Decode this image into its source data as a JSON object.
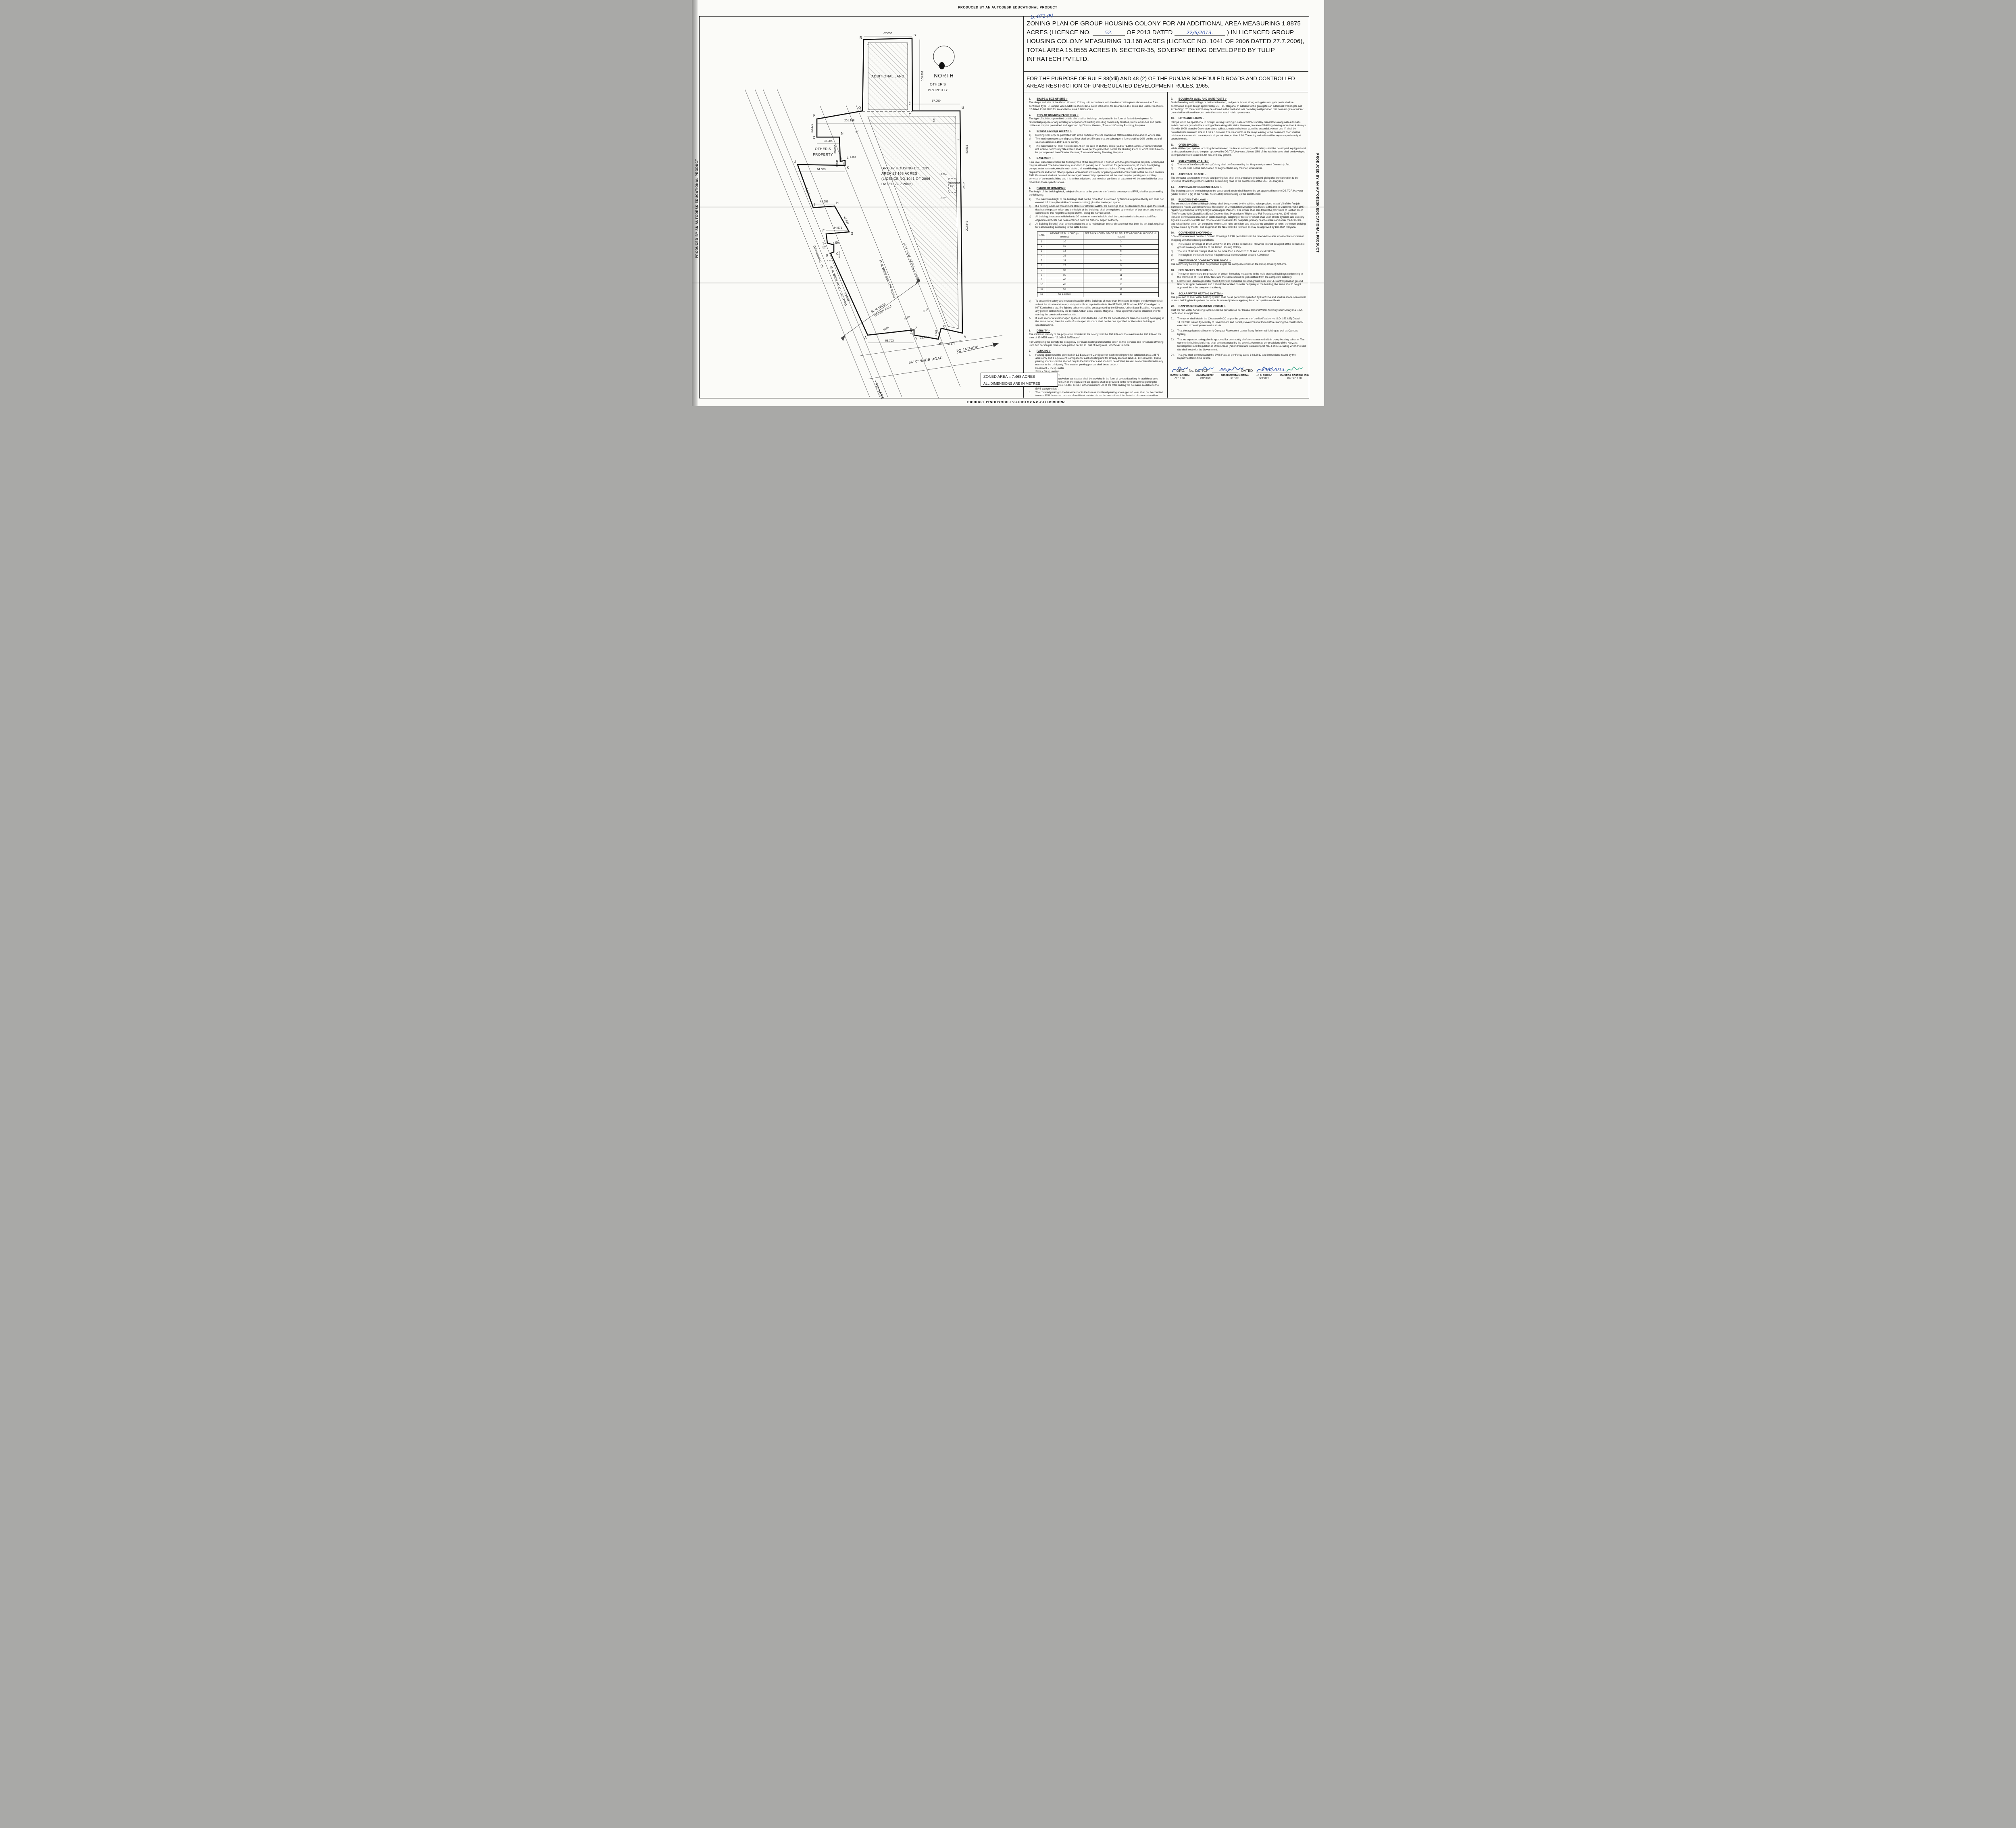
{
  "edge_text": "PRODUCED BY AN AUTODESK EDUCATIONAL PRODUCT",
  "header": {
    "ref_handwritten": "Lc-871 (R)",
    "title_part1": "ZONING PLAN OF GROUP HOUSING COLONY FOR AN ADDITIONAL AREA MEASURING 1.8875 ACRES (LICENCE NO.",
    "licence_no_handwritten": "52.",
    "title_part2": "OF 2013 DATED",
    "licence_date_handwritten": "22/6/2013.",
    "title_part3": ") IN LICENCED GROUP HOUSING COLONY MEASURING 13.168 ACRES (LICENCE NO. 1041 OF 2006 DATED 27.7.2006), TOTAL AREA 15.0555 ACRES IN SECTOR-35, SONEPAT BEING DEVELOPED BY TULIP INFRATECH PVT.LTD.",
    "subtitle": "FOR THE PURPOSE OF RULE 38(xlii) AND 48 (2) OF THE PUNJAB SCHEDULED ROADS AND CONTROLLED  AREAS RESTRICTION OF UNREGULATED DEVELOPMENT RULES, 1965."
  },
  "clauses_left": [
    {
      "num": "1.",
      "title": "SHAPE & SIZE OF SITE :-",
      "paras": [
        "The shape and size of the Group Housing Colony is in accordance with the demarcation plans shown as A to Z as confirmed by DTP, Sonipat vide Endst No. 25/06-3912 dated 30.8.2006 for an area 13.168 acres and Endst. No. 25/06-37 dated 13.03.2013 for an additional area 1.8875 acres."
      ]
    },
    {
      "num": "2.",
      "title": "TYPE OF BUILDING PERMITTED :-",
      "paras": [
        "The type of buildings permitted on this site shall be buildings designated in the form of flatted development for residential purpose or any ancillary or appurtenant building including community facilities, Public amenities and public utilities as may be prescribed and approved by Director General,  Town and Country Planning, Haryana."
      ]
    },
    {
      "num": "3.",
      "title": "Ground Coverage and FAR :-",
      "items": [
        {
          "l": "a)",
          "t": "Building shall only be permitted with in the portion of the site marked as  ▨▨  buildable  zone and no  where else."
        },
        {
          "l": "b)",
          "t": "The maximum coverage of ground floor shall be 35% and that on subsequent floors  shall be 30% on the area of 15.0555 acres (13.168+1.8875 acres)."
        },
        {
          "l": "c)",
          "t": "The maximum FAR shall not exceed 175 on the area of 15.0555  acres (13.168+1.8875 acres) . However it shall not include Community Sites which shall be as per the prescribed norms the Building Plans of which shall have to be got approved from Director General,  Town and Country Planning, Haryana."
        }
      ]
    },
    {
      "num": "4.",
      "title": "BASEMENT :-",
      "paras": [
        "Four level Basements within the building zone of the site provided it flushed with the ground and is properly landscaped may be allowed. The basement may in addition to parking could be utilized for generator room, lift room, fire fighting pumps, water reservoir, electric sub- station, air conditioning plants and toilets, if they satisfy the public health requirements and for no other purposes. Area under stilts (only for parking) and basement shall not be counted towards FAR. Basement shall not be used for storage/commercial purposes but will be used only for parking and ancillary services of the main building and it is further, stipulated that no other partitions of basement will be permissible for uses other than those specific above ."
      ]
    },
    {
      "num": "5.",
      "title": "HEIGHT OF BUILDING :-",
      "paras": [
        "The height of the building block, subject of course to the provisions of the site coverage and FAR, shall be governed by the following:-"
      ],
      "items": [
        {
          "l": "a)",
          "t": "The maximum height of the buildings shall not be more than as allowed by National Airport Authority and shall not exceed 1.5 times (the width of the road abutting) plus the front  open space."
        },
        {
          "l": "b)",
          "t": "If a building abuts on two or more streets of different widths, the buildings shall be deemed to face  upon the street that has the greater width and the height of the buildings shall be regulated by the width of that street and may be continued to this height to a depth of 24M, along the narrow street."
        },
        {
          "l": "c)",
          "t": "All building /structures which rise to 30 meters or more in height shall be constructed shall constructed if no objection certificate has been obtained from the National Airport Authority."
        },
        {
          "l": "d)",
          "t": "All Building Block(s) shall be constructed so as to maintain an interse distance not less then the set back required for each building according to the table below:-"
        }
      ],
      "insert_table": true,
      "items2": [
        {
          "l": "e)",
          "t": "To ensure fire safety and structural stability of the Buildings of more than 60 meters in height, the developer shall submit the structural drawings duly vetted from reputed institute like IIT Delhi, IIT Roorkee, PEC Chandigarh or NIT Kurukshetra etc. fire fighting scheme shall be got approved by the Director, Urban Local Boadies, Haryana or any person authorized by the Director, Urban Local Bodies, Haryana. These approval shall be obtained prior to starting the construction work at site."
        },
        {
          "l": "f)",
          "t": "If such interior or exterior open space is intended to be used for the benefit of more than one building belonging to the same owner, then the width of such open air space  shall be the one specified for the tallest building as specified above."
        }
      ]
    },
    {
      "num": "6.",
      "title": "DENSITY :-",
      "paras": [
        "The minimum density of the population provided in the colony shall be 100 PPA and the maximum be 400 PPA on the area of 15.0555 acres (13.168+1.8875 acres).",
        "For Computing the density the occupancy per main dwelling unit shall be taken as five persons and for service dwelling units two person per room or one person per 80 sq. feet of living area, whichever is more."
      ]
    },
    {
      "num": "7.",
      "title": "PARKING :-",
      "items": [
        {
          "l": "a.",
          "t": "Parking space shall be provided @ 1.5 Equivalent Car Space for each dwelling unit for additional area 1.8875 acres only and 1 Equivalent Car Space for each dwelling unit for already licenced land i.e. 13.168 acres. These parking spaces shall be allotted only to the flat holders and shall not be allotted,  leased, sold or transferred in any manner to the third party. The area for parking per car shall be as under:-\nBasement            =        35 sq. meter\nStilts                     =        30 sq. meters\nOpen                    =        25 sq. meters"
        },
        {
          "l": "b.",
          "t": "At least 75% of the equivalent car spaces shall be provided in the form of covered parking for additional area 1.8875 acres only and 50% of the equivalent car spaces shall be provided in the form of covered parking for already licenced land i.e. 13.168 acres. Further minimum 5% of the total parking will be made available to the EWS category flats ."
        },
        {
          "l": "c.",
          "t": "The covered parking in the basement or in the form of multilevel parking above ground level shall not be counted towards FAR. However, in case of multilevel parking above the ground level the footprint of separate parking building block shall be counted towards ground coverage. In case of provision of mechanical parking in the basement floor/upper storey's, the floor to ceiling heights of the basement of the upper floor may be maximum of 4.5 meter other then the mechanical parking the floor to ceiling height in upper floor shall not be more then 2.4 meter below the hanging beam."
        }
      ]
    },
    {
      "num": "8.",
      "title": "ACCOMMODATION FOR SERVICE POPULATION  :-",
      "paras": [
        "Adequate accommodation shall be provided for domestic servants and other service population of EWS. The number of such dwelling units for domestic servants shall not be less then 10% of the number of main dwelling units and the carpet area of such a unit if attach to the main unit shall not be less then 140 sq. feet, in addition 15% of the total number of dwelling units having a minimum area of 200 sq. feet shall be earmarked for EWS category."
      ]
    }
  ],
  "clauses_right": [
    {
      "num": "9.",
      "title": "BOUNDARY WALL AND GATE POSTS :-",
      "paras": [
        "Such Boundary wall, railings or their combination, hedges or fences along with gates and gate posts shall be constructed as per design approved by DG,TCP Haryana. In addition to the gate/gates an additional wicket gate not exceeding 1.25 meters width may be allowed in the front and side boundary wall provided that no main gate or wicket gate shall be allowed to open on to the sector road/ public open space."
      ]
    },
    {
      "num": "10.",
      "title": "LIFTS AND RAMPS :-",
      "paras": [
        "Ramps would be operational in Group Housing Building in case of 100% stand by Generators along with automatic switch over are provided for running of flats along with stairs. However, in case of Buildings having more than 4 storey's lifts with 100% standby Generators along with automatic switchover would be essential. Atleast one lift shall be provided with minimum size of 1.80 X  3.0 meter. The clear width of the ramp leading to the basement floor shall be minimum 4 metres with an adequate slope not steeper than 1:10. The entry and exit shall be separate preferably at opposite ends."
      ]
    },
    {
      "num": "11.",
      "title": "OPEN SPACES  :-",
      "paras": [
        "While all the open spaces including those between the blocks and wings of Buildings shall be developed, equipped and land scaped according to the plan approved by DG,TCP, Haryana. Atleast 15% of the total site area shall be developed as organized open space i.e. tot lots and play ground."
      ]
    },
    {
      "num": "12",
      "title": "SUB DIVISION OF SITE :-",
      "items": [
        {
          "l": "a)",
          "t": "The site of the Group Housing Colony shall be Governed by the Haryana Apartment Ownership Act."
        },
        {
          "l": "b)",
          "t": "The site shall not be sub-divided or fragmented in any  manner, whatsoever."
        }
      ]
    },
    {
      "num": "13.",
      "title": "APPROACH TO SITE :-",
      "paras": [
        "The vehicular approach to the site and parking lots shall be planned and provided giving due consideration to the junctions off and the junctions with the surrounding road to the satisfaction of the DG,TCP, Haryana."
      ]
    },
    {
      "num": "14.",
      "title": "APPROVAL OF BUILDING PLANS :-",
      "paras": [
        "The building plans of the buildings to be constructed at site shall have to be got approved from the DG,TCP, Haryana (under section 8 (2) of the Act No. 41 of 1963) before taking up the construction."
      ]
    },
    {
      "num": "15.",
      "title": "BUILDING BYE- LAWS :-",
      "paras": [
        "The construction of the building/buildings shall be governed by the building rules provided in part  VII of the Punjab Scheduled Roads Controlled Areas, Restriction of Unregulated Development Rules, 1965 and IS Code No. 4963-1987 regarding provisions for Physically Handicapped Persons. The owner shall also follow the provisions of Section 46 of 'The Persons With Disabilities (Equal Opportunities, Protection of Rights and Full Participation) Act, 1995' which includes construction of ramps in public buildings, adapting of toilets for wheel chair user, Braille symbols and auditory signals in elevators or lifts and other relevant measures for hospitals, primary health centres and other medical care  and rehabilitation units. On  the points where such rules are silent and stipulate no condition or norm, the model building byelaw issued by the ISI, and as given in the NBC shall be followed as may be approved by DG,TCP, Haryana."
      ]
    },
    {
      "num": "16.",
      "title": "CONVENIENT SHOPPING :-",
      "paras": [
        "0.5% of the total area on which Ground Coverage & FAR permitted shall be reserved to cater for essential convenient shopping with the following conditions"
      ],
      "items": [
        {
          "l": "a)",
          "t": "The Ground coverage of 100% with FAR of 100 will be permissible. However this will be a part of the permissible ground coverage and FAR of the Group Housing Colony."
        },
        {
          "l": "b)",
          "t": "The size of Kiosks / shops shall not be more than 2.75 M x 2.75 M and 2.75 M x 8.25M."
        },
        {
          "l": "c)",
          "t": "The height of the kiosks / shops / departmental store shall not exceed 4.00 meter."
        }
      ]
    },
    {
      "num": "17",
      "title": "PROVISION OF COMMUNITY BUILDINGS :-",
      "paras": [
        "The community buildings shall be provided as per the composite norms in the Group Housing Scheme."
      ]
    },
    {
      "num": "18.",
      "title": "FIRE SAFETY MEASURES :-",
      "items": [
        {
          "l": "a)",
          "t": "The  owner will ensure the provision of  proper fire safety measures in the  multi storeyed buildings conforming to the provisions of Rules 1965/ NBC and  the same should be got certified from the competent authority."
        },
        {
          "l": "b)",
          "t": "Electric Sub Station/generator room if provided should be on solid ground near DG/LT. Control panel on ground floor or in upper basement and it should be located on outer periphery of the building, the same should be got approved from the competent authority."
        }
      ]
    },
    {
      "num": "19.",
      "title": "SOLAR WATER HEATING SYSTEM  :-",
      "paras": [
        "The provision of solar water heating system shall be as per norms specified by HAREDA and shall be made operational in each building blocks (where hot water is required) before applying for an occupation certificate."
      ]
    },
    {
      "num": "20.",
      "title": "RAIN WATER HARVESTING SYSTEM  :-",
      "paras": [
        "That the rain water harvesting system shall be provided as per Central Ground Water Authority norms/Haryana Govt. notification as applicable."
      ]
    },
    {
      "items": [
        {
          "l": "21.",
          "t": "The owner shall obtain the Clearance/NOC as per the provisions of the Notification  No. S.O. 1533 (E) Dated 14.09.2006 issued by Ministry of Environment and Forest, Government of India before starting the construction/ execution of development works at site."
        }
      ]
    },
    {
      "items": [
        {
          "l": "22.",
          "t": "That the applicant shall use only Compact Fluorescent Lamps fitting for internal lighting as well as Campus lighting."
        }
      ]
    },
    {
      "items": [
        {
          "l": "23.",
          "t": "That no separate zoning plan is approved for community site/sites earmarked within group housing scheme. The community building/buildings shall be constructed by the coloniser/owner as per provisions of the Haryana Development and Regulation of Urban Areas (Amendment and validation) Act No. 4 of 2012, failing which the said site shall vest with the Government."
        }
      ]
    },
    {
      "items": [
        {
          "l": "24.",
          "t": "That you shall construct/allot the EWS Flats  as per Policy dated 14.6.2012 and instructions  issued by the Department from time to time."
        }
      ]
    }
  ],
  "table": {
    "headers": [
      "S.No.",
      "HEIGHT  OF  BUILDING (in  meters)",
      "SET  BACK  /  OPEN  SPACE  TO  BE  LEFT AROUND  BUILDINGS.  (in  meters)"
    ],
    "rows": [
      [
        "1",
        "10",
        "3"
      ],
      [
        "2",
        "15",
        "5"
      ],
      [
        "3",
        "18",
        "6"
      ],
      [
        "4",
        "21",
        "7"
      ],
      [
        "5",
        "24",
        "8"
      ],
      [
        "6",
        "27",
        "9"
      ],
      [
        "7",
        "30",
        "10"
      ],
      [
        "8",
        "35",
        "11"
      ],
      [
        "9",
        "40",
        "12"
      ],
      [
        "10",
        "45",
        "13"
      ],
      [
        "11",
        "50",
        "14"
      ],
      [
        "12",
        "55 & above",
        "16"
      ]
    ]
  },
  "drg": {
    "label": "DRG.",
    "no_label": "No.  DG,TCP",
    "no_value": "3952",
    "dated_label": "DATED",
    "dated_value": "24/6/2013."
  },
  "signatures": [
    {
      "name": "(SATISH ARORA)",
      "title": "ATP (HQ)",
      "ink": "#2b4fa0"
    },
    {
      "name": "(SUNITA SETHI)",
      "title": "DTP (HQ)",
      "ink": "#3f6fc0"
    },
    {
      "name": "(MADHUSMITA MOITRA)",
      "title": "STP,(M)",
      "ink": "#2b4fa0"
    },
    {
      "name": "(J. S. REDHU)",
      "title": "CTP,(HR)",
      "ink": "#3a5da8"
    },
    {
      "name": "(ANURAG RASTOGI, IAS)",
      "title": "DG,TCP (HR)",
      "ink": "#3aa88a"
    }
  ],
  "plan": {
    "north_label": "NORTH",
    "additional_land": "ADDITIONAL LAND",
    "additional_small_1": "ADDITIONAL",
    "additional_small_2": "LAND",
    "others_1": "OTHER'S",
    "others_2": "PROPERTY",
    "ghc_1": "GROUP HOUSING COLONY",
    "ghc_2": "AREA 13.168 ACRES",
    "ghc_3": "(LICENCE NO.1041 OF 2006",
    "ghc_4": "DATED 27.7.2006)",
    "roads": {
      "drain": "DRAIN/NALLAH",
      "r15": "15 M WIDE ROAD EXISTING",
      "green_1": "50 M WIDE",
      "green_2": "GREEN BELT",
      "sector": "45 M WIDE SECTOR ROAD",
      "service": "12 M WIDE SERVICE ROAD",
      "wide66": "66'-0\" WIDE ROAD",
      "to_jatheri": "TO JATHERI",
      "to_narela": "TO NARELA"
    },
    "zoned_area": "ZONED AREA = 7.468 ACRES",
    "dims_note": "ALL DIMENSIONS ARE IN METRES",
    "dims": {
      "d67": "67.050",
      "d108": "108.891",
      "d201": "201.168",
      "d23": "23.470",
      "d33": "33.985",
      "d36": "36.880",
      "d3": "3.353",
      "d64": "64.553",
      "d61": "61.163",
      "d41": "41.693",
      "d43": "43.539",
      "d34": "34.976",
      "d17": "17.007",
      "d8": "8.382",
      "d10": "10.058",
      "d124": "124.597",
      "d63": "63.703",
      "d1_6": "1.676",
      "d38": "38.687",
      "d9_9": "9.969",
      "d30": "30.175",
      "d202": "202.845",
      "d83": "83.819",
      "d20": "20.117",
      "d16": "16.764",
      "d6": "6.0",
      "d50": "50.00",
      "d45": "45.00",
      "d12": "12.00"
    },
    "points": {
      "A": "A",
      "B": "B",
      "C": "C",
      "D": "D",
      "E": "E",
      "F": "F",
      "G": "G",
      "H": "H",
      "I": "I",
      "J": "J",
      "K": "K",
      "L": "L",
      "M": "M",
      "N": "N",
      "O": "O",
      "P": "P",
      "Q": "Q",
      "R": "R",
      "S": "S",
      "T": "T",
      "U": "U",
      "V": "V",
      "W": "W",
      "X": "X",
      "Y": "Y",
      "Z": "Z"
    }
  }
}
